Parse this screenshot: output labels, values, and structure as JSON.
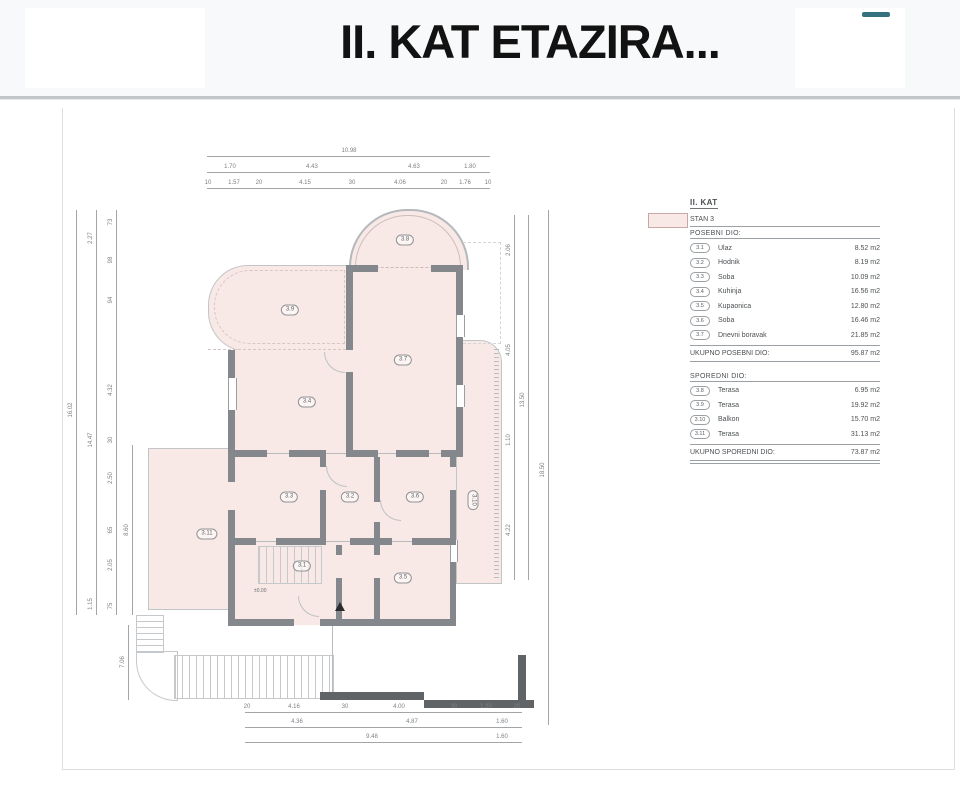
{
  "header": {
    "title": "II. KAT ETAZIRA..."
  },
  "legend": {
    "title": "II. KAT",
    "unit_label": "STAN 3",
    "posebni": {
      "header": "POSEBNI DIO:",
      "rows": [
        {
          "no": "3.1",
          "name": "Ulaz",
          "area": "8.52 m2"
        },
        {
          "no": "3.2",
          "name": "Hodnik",
          "area": "8.19 m2"
        },
        {
          "no": "3.3",
          "name": "Soba",
          "area": "10.09 m2"
        },
        {
          "no": "3.4",
          "name": "Kuhinja",
          "area": "16.56 m2"
        },
        {
          "no": "3.5",
          "name": "Kupaonica",
          "area": "12.80 m2"
        },
        {
          "no": "3.6",
          "name": "Soba",
          "area": "16.46 m2"
        },
        {
          "no": "3.7",
          "name": "Dnevni boravak",
          "area": "21.85 m2"
        }
      ],
      "total_label": "UKUPNO POSEBNI DIO:",
      "total_value": "95.87 m2"
    },
    "sporedni": {
      "header": "SPOREDNI DIO:",
      "rows": [
        {
          "no": "3.8",
          "name": "Terasa",
          "area": "6.95 m2"
        },
        {
          "no": "3.9",
          "name": "Terasa",
          "area": "19.92 m2"
        },
        {
          "no": "3.10",
          "name": "Balkon",
          "area": "15.70 m2"
        },
        {
          "no": "3.11",
          "name": "Terasa",
          "area": "31.13 m2"
        }
      ],
      "total_label": "UKUPNO SPOREDNI DIO:",
      "total_value": "73.87 m2"
    }
  },
  "plan": {
    "rooms": {
      "r1": "3.1",
      "r2": "3.2",
      "r3": "3.3",
      "r4": "3.4",
      "r5": "3.5",
      "r6": "3.6",
      "r7": "3.7",
      "r8": "3.8",
      "r9": "3.9",
      "r10": "3.10",
      "r11": "3.11"
    },
    "level_mark": "±0.00",
    "dims": {
      "top": {
        "total": "10.98",
        "row2": [
          "1.70",
          "4.43",
          "4.63",
          "1.80"
        ],
        "row3": [
          "10",
          "1.57",
          "20",
          "4.15",
          "30",
          "4.06",
          "20",
          "1.76",
          "10"
        ]
      },
      "left": {
        "total": "16.02",
        "row2": [
          "2.27",
          "14.47",
          "1.15"
        ],
        "row3": [
          "73",
          "98",
          "94",
          "4.32",
          "30",
          "2.50",
          "65",
          "2.05",
          "75"
        ],
        "row4": "8.60",
        "stair": "7.06"
      },
      "right": {
        "inner": [
          "2.06",
          "4.05",
          "1.10",
          "4.22"
        ],
        "mid": "13.50",
        "outer": "18.50"
      },
      "bottom": {
        "row1": [
          "20",
          "4.16",
          "30",
          "4.00",
          "30",
          "1.20",
          "20"
        ],
        "row2": [
          "4.36",
          "4.87",
          "1.60"
        ],
        "row3": [
          "9.48",
          "1.60"
        ]
      }
    }
  },
  "colors": {
    "room_fill": "#f8e8e6",
    "wall": "#84888c",
    "accent_dash": "#35707e"
  }
}
